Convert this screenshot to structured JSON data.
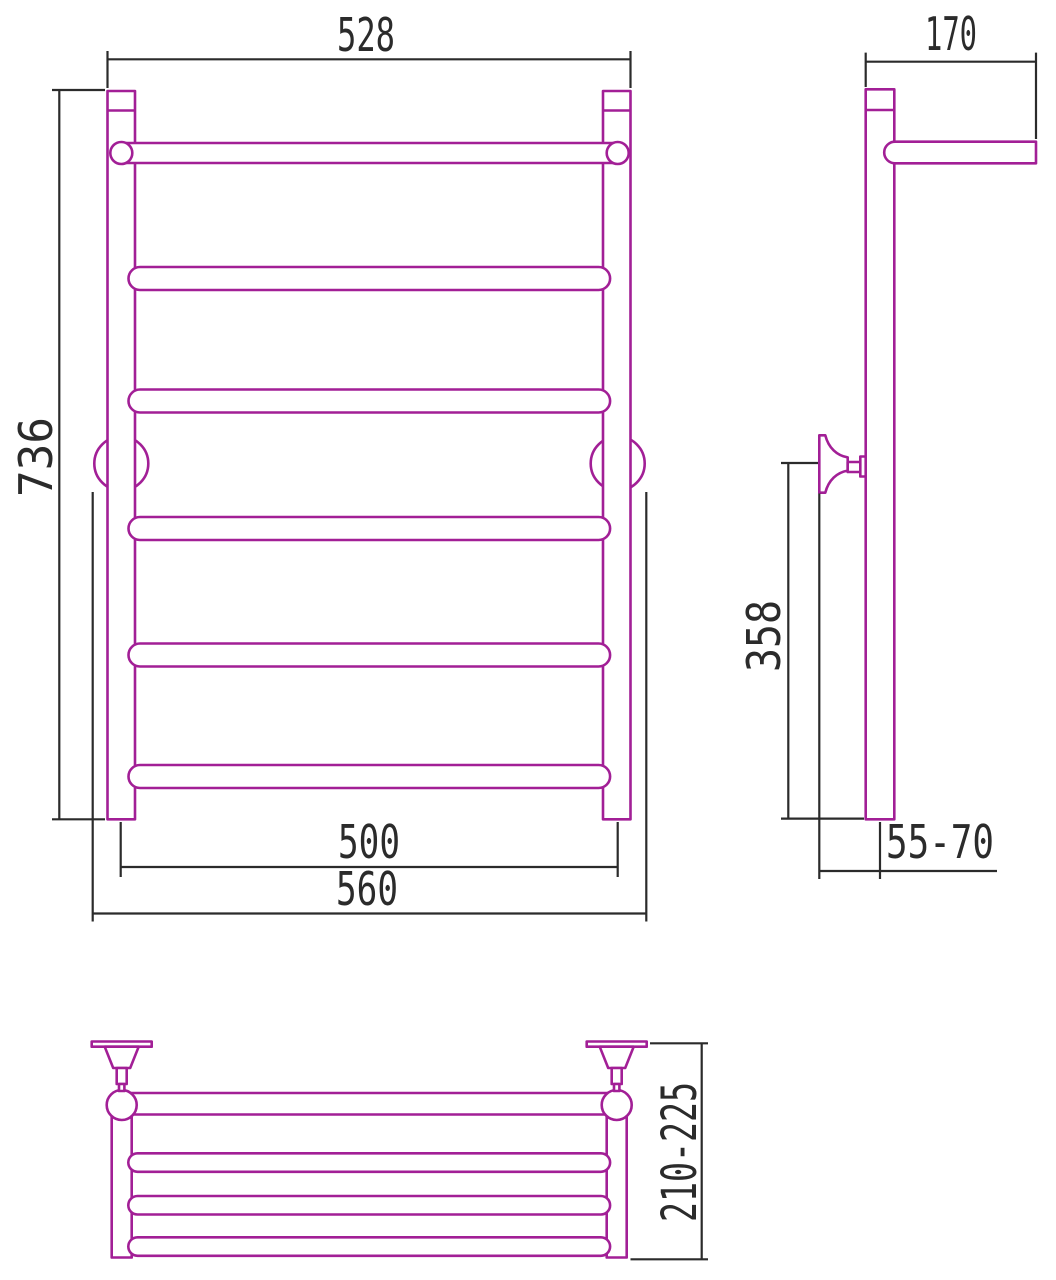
{
  "drawing": {
    "colors": {
      "part_outline": "#a21f96",
      "dimension_lines": "#2b2b2b",
      "background": "#ffffff"
    },
    "dims": {
      "front_width": "528",
      "front_height": "736",
      "front_rail_span": "500",
      "front_bracket_span": "560",
      "side_depth": "170",
      "side_bracket_height": "358",
      "side_wall_offset": "55-70",
      "plan_shelf_depth": "210-225"
    },
    "structure": {
      "front_rung_count": 6,
      "plan_slat_count": 4,
      "view_count": 3
    }
  }
}
